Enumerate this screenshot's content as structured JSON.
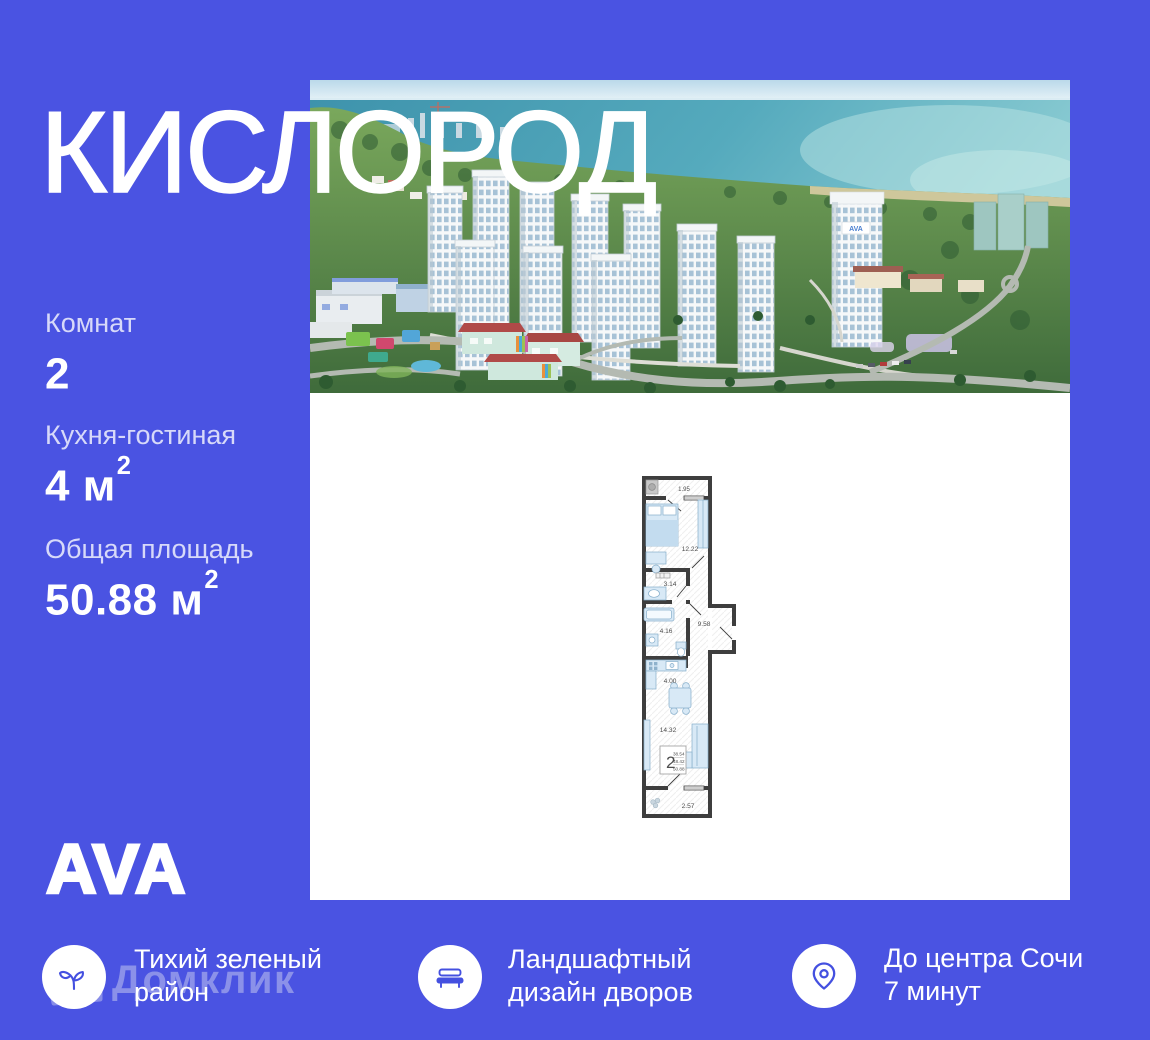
{
  "title": "КИСЛОРОД",
  "stats": [
    {
      "label": "Комнат",
      "value": "2",
      "sup": ""
    },
    {
      "label": "Кухня-гостиная",
      "value": "4 м",
      "sup": "2"
    },
    {
      "label": "Общая площадь",
      "value": "50.88 м",
      "sup": "2"
    }
  ],
  "brand_logo": "AVA",
  "watermark_text": "Домклик",
  "photo": {
    "tower_sign": "AVA"
  },
  "floor_plan": {
    "rooms": [
      {
        "name": "loggia",
        "area": "1.95"
      },
      {
        "name": "bedroom",
        "area": "12.22"
      },
      {
        "name": "bathroom",
        "area": "3.14"
      },
      {
        "name": "bathroom-2",
        "area": "4.16"
      },
      {
        "name": "hallway",
        "area": "9.58"
      },
      {
        "name": "kitchen",
        "area": "4.00"
      },
      {
        "name": "living-room",
        "area": "14.32"
      },
      {
        "name": "balcony",
        "area": "2.57"
      }
    ],
    "summary": {
      "rooms": "2",
      "area_living": "38.54",
      "area_no_balcony": "48.42",
      "area_total": "50.88"
    }
  },
  "features": [
    {
      "icon": "sprout-icon",
      "line1": "Тихий зеленый",
      "line2": "район"
    },
    {
      "icon": "bench-icon",
      "line1": "Ландшафтный",
      "line2": "дизайн дворов"
    },
    {
      "icon": "location-pin-icon",
      "line1": "До центра Сочи",
      "line2": "7 минут"
    }
  ],
  "colors": {
    "background": "#4A53E2",
    "accent_icon": "#4450E0",
    "panel": "#FFFFFF"
  }
}
